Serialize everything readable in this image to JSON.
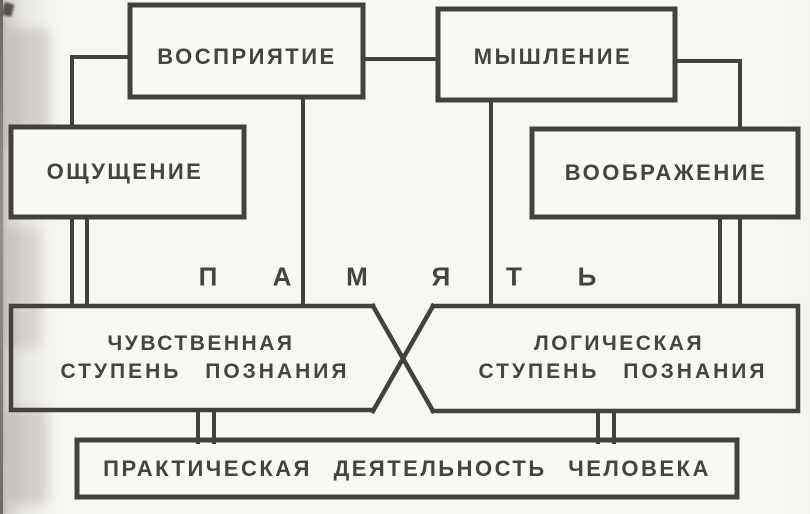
{
  "page": {
    "background": "#f8f7f4",
    "line_color": "#424140",
    "text_color": "#464441"
  },
  "boxes": {
    "perception": {
      "label": "ВОСПРИЯТИЕ"
    },
    "thinking": {
      "label": "МЫШЛЕНИЕ"
    },
    "sensation": {
      "label": "ОЩУЩЕНИЕ"
    },
    "imagination": {
      "label": "ВООБРАЖЕНИЕ"
    },
    "practical_activity": {
      "label": "ПРАКТИЧЕСКАЯ  ДЕЯТЕЛЬНОСТЬ  ЧЕЛОВЕКА"
    }
  },
  "memory": {
    "word": "ПАМЯТЬ",
    "letters": [
      "П",
      "А",
      "М",
      "Я",
      "Т",
      "Ь"
    ]
  },
  "banners": {
    "sensory_stage": {
      "line1": "ЧУВСТВЕННАЯ",
      "line2": "СТУПЕНЬ  ПОЗНАНИЯ"
    },
    "logical_stage": {
      "line1": "ЛОГИЧЕСКАЯ",
      "line2": "СТУПЕНЬ  ПОЗНАНИЯ"
    }
  }
}
